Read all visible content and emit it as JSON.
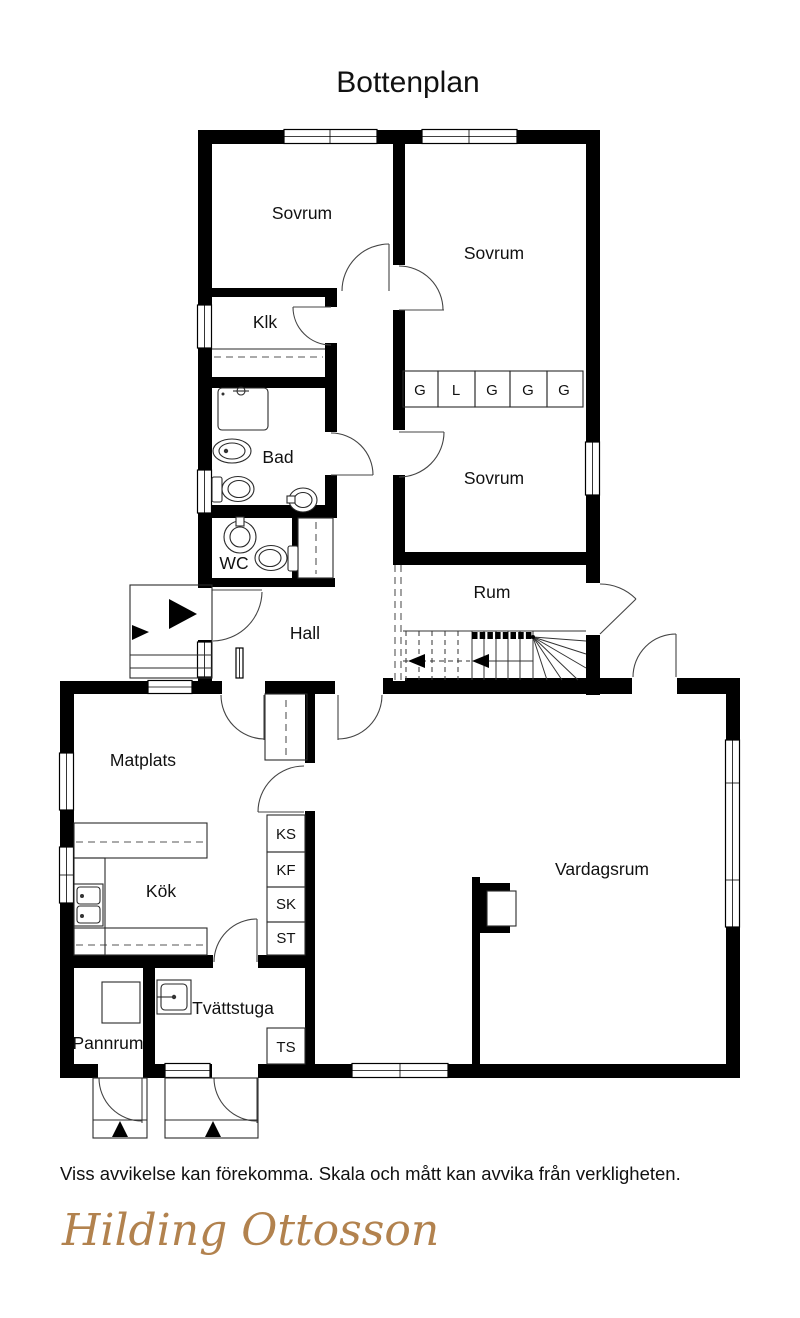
{
  "title": "Bottenplan",
  "disclaimer": "Viss avvikelse kan förekomma. Skala och mått kan avvika från verkligheten.",
  "brand": "Hilding Ottosson",
  "colors": {
    "wall": "#000000",
    "label": "#111111",
    "logo": "#b2824e",
    "background": "#ffffff"
  },
  "plan": {
    "rooms": {
      "sovrum1": "Sovrum",
      "sovrum2": "Sovrum",
      "sovrum3": "Sovrum",
      "klk": "Klk",
      "bad": "Bad",
      "wc": "WC",
      "hall": "Hall",
      "rum": "Rum",
      "matplats": "Matplats",
      "kok": "Kök",
      "vardagsrum": "Vardagsrum",
      "tvattstuga": "Tvättstuga",
      "pannrum": "Pannrum"
    },
    "wardrobes": [
      "G",
      "L",
      "G",
      "G",
      "G"
    ],
    "cabinets": [
      "KS",
      "KF",
      "SK",
      "ST"
    ],
    "laundry_cabinet": "TS"
  }
}
